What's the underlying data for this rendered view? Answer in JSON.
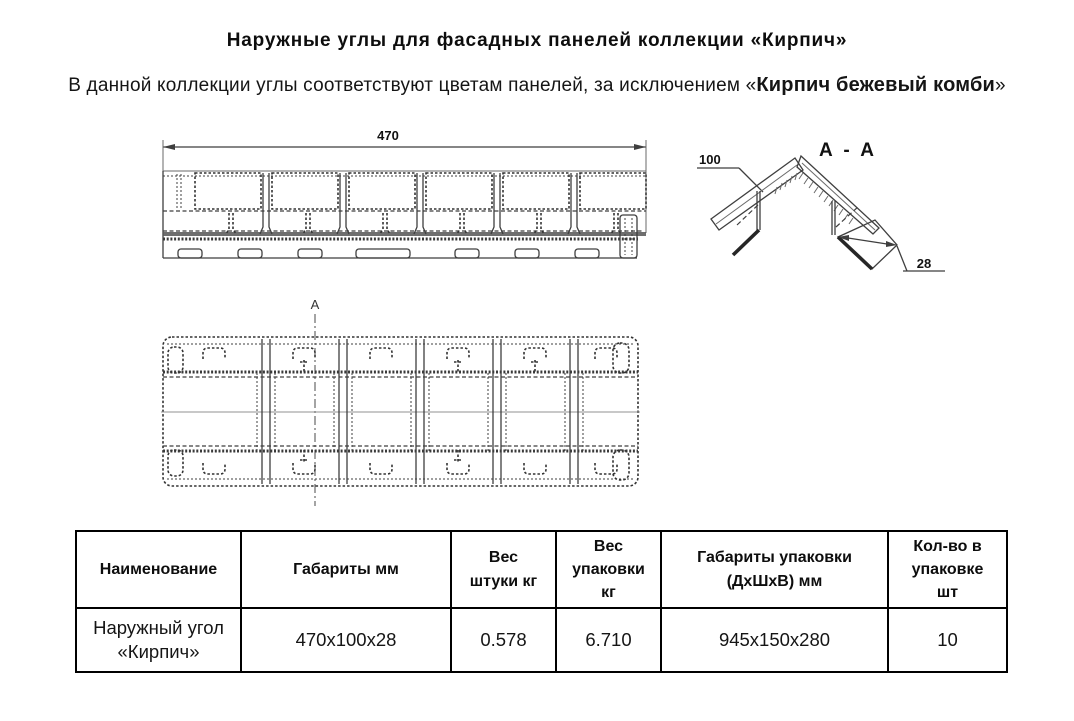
{
  "page": {
    "title": "Наружные углы для фасадных панелей коллекции «Кирпич»",
    "subtitle_prefix": "В данной коллекции углы соответствуют цветам панелей, за исключением «",
    "subtitle_bold": "Кирпич бежевый комби",
    "subtitle_suffix": "»"
  },
  "drawings": {
    "front_view": {
      "length_dim": "470"
    },
    "section_view": {
      "title": "A - A",
      "width_dim": "100",
      "thickness_dim": "28"
    },
    "plan_view": {
      "section_mark": "A"
    }
  },
  "table": {
    "headers": [
      "Наименование",
      "Габариты мм",
      "Вес\nштуки кг",
      "Вес\nупаковки\nкг",
      "Габариты упаковки\n(ДхШхВ) мм",
      "Кол-во в\nупаковке\nшт"
    ],
    "rows": [
      {
        "name": "Наружный угол\n«Кирпич»",
        "dimensions": "470х100х28",
        "unit_weight": "0.578",
        "pack_weight": "6.710",
        "pack_dimensions": "945х150х280",
        "pack_qty": "10"
      }
    ]
  },
  "colors": {
    "background": "#ffffff",
    "text": "#111111",
    "drawing_line": "#3f3f3f",
    "table_border": "#000000"
  }
}
